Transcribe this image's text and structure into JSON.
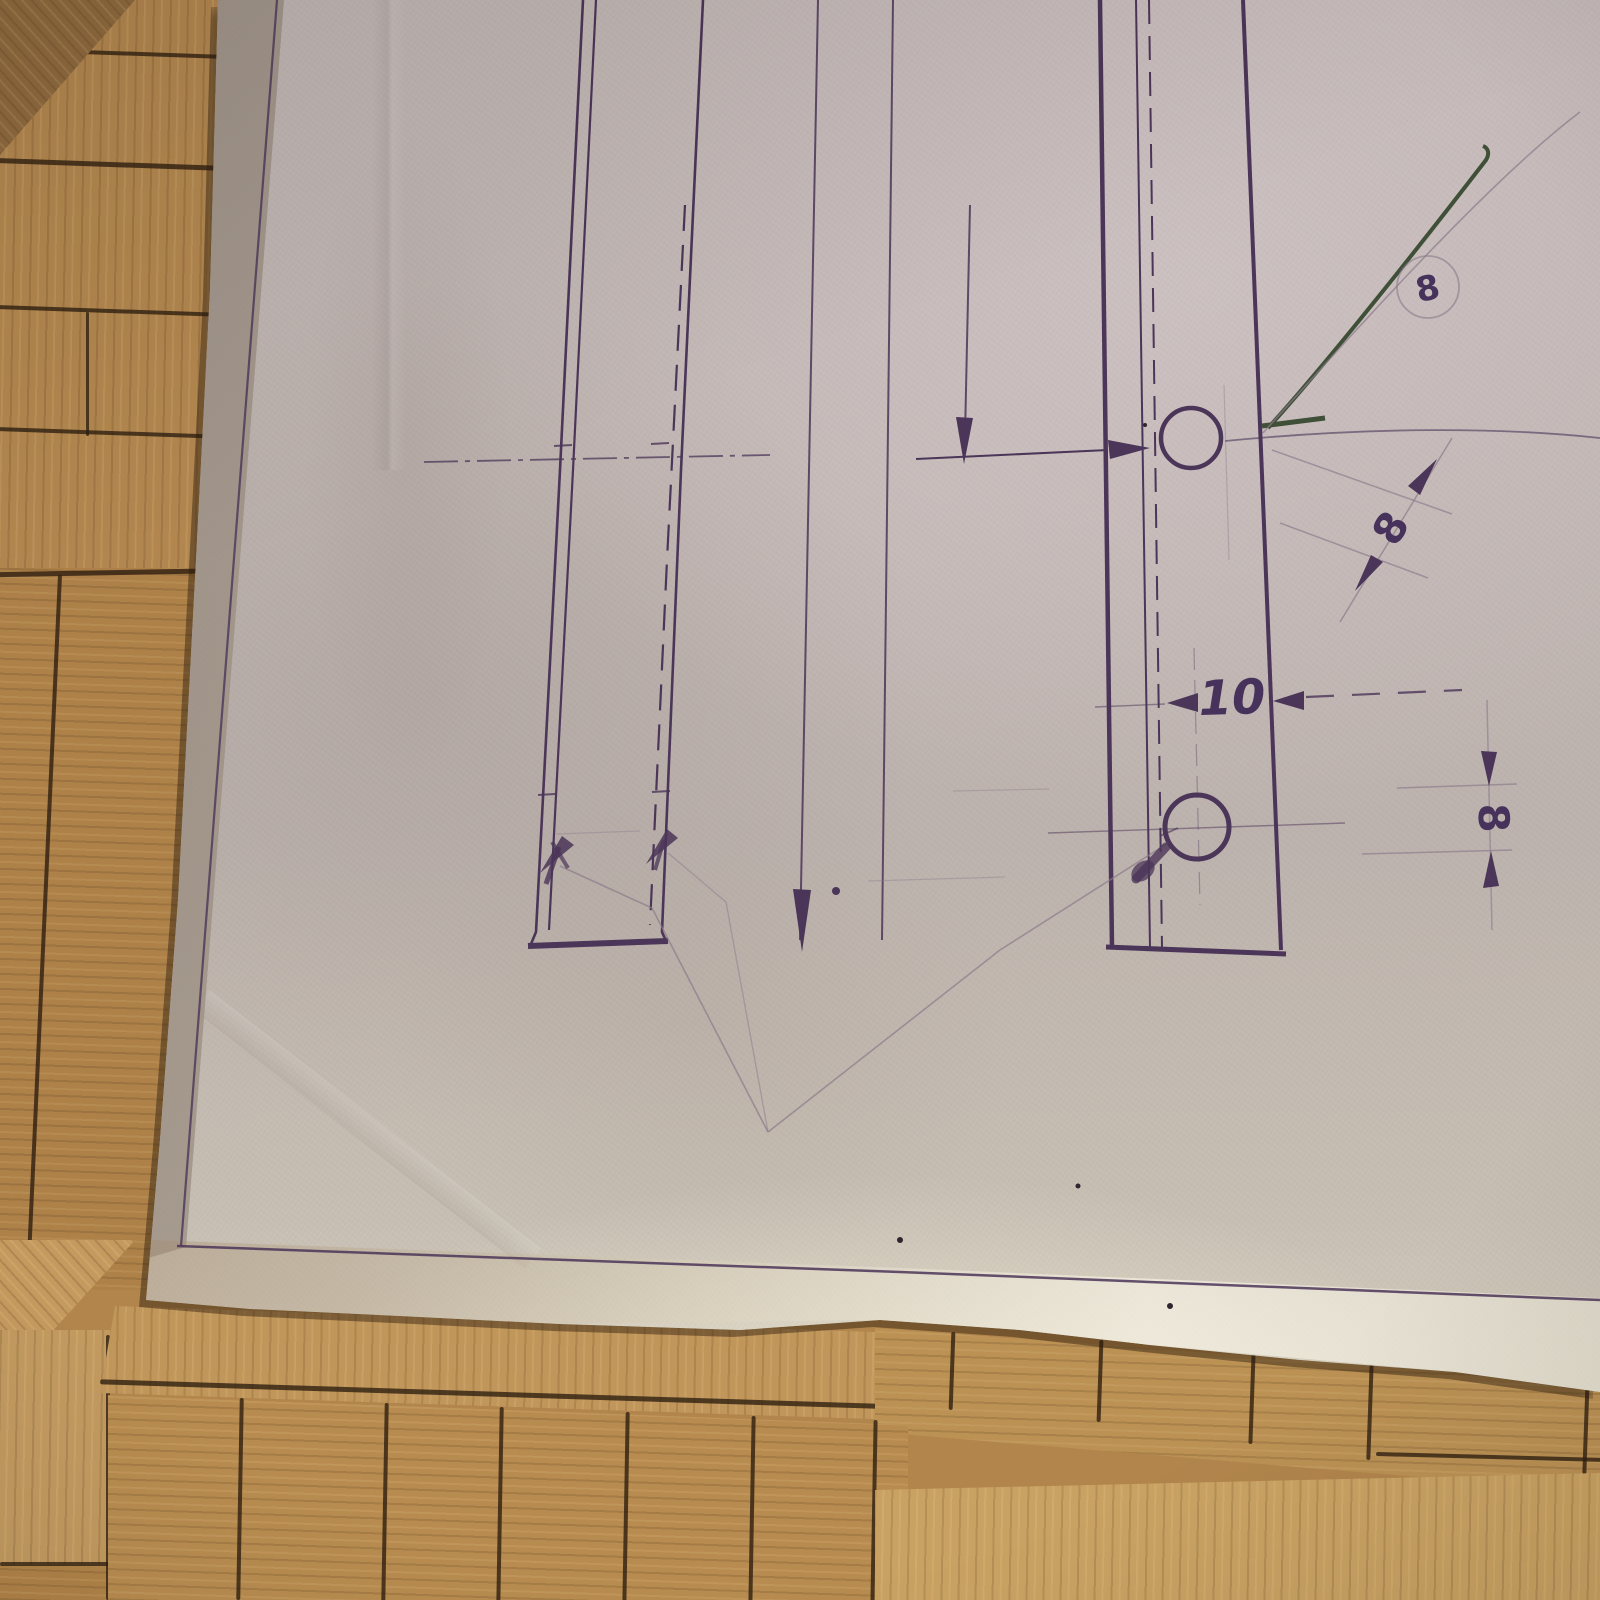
{
  "scene": {
    "description": "hand-drafted technical drawing in violet ink and pencil on grey tracing paper, photographed lying on an oak parquet floor"
  },
  "drawing": {
    "dim_width_label": "10",
    "dim_diagonal_label": "8",
    "dim_right_label": "8",
    "balloon_label": "8"
  },
  "colors": {
    "ink": "#4b3558",
    "pencil": "#8b7a8a",
    "green_leader": "#3f4f38",
    "paper": "#bdb3ae",
    "paper_fold": "#a89b8e",
    "wood_mid": "#b1854c",
    "wood_light": "#c9a05f",
    "wood_seam": "#2b1c0e"
  }
}
